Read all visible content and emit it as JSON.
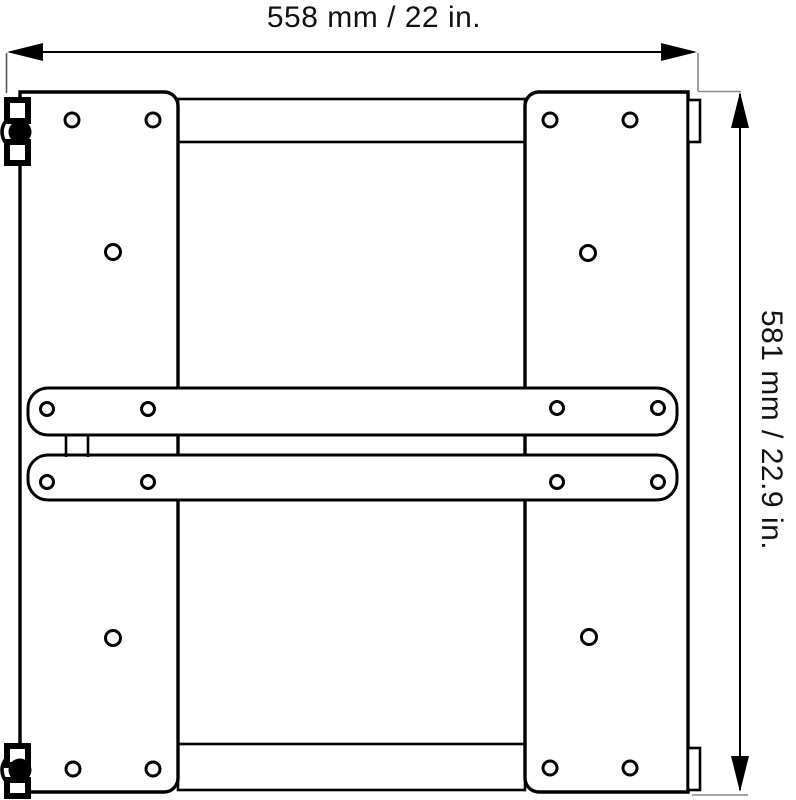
{
  "figure": {
    "type": "technical-drawing",
    "subject": "mounting-bracket-rear-view",
    "background_color": "#ffffff",
    "line_color": "#000000",
    "extension_line_color": "#888888",
    "width_dimension": {
      "label": "558 mm / 22 in.",
      "mm": "558",
      "inches": "22"
    },
    "height_dimension": {
      "label": "581 mm / 22.9 in.",
      "mm": "581",
      "inches": "22.9"
    }
  }
}
